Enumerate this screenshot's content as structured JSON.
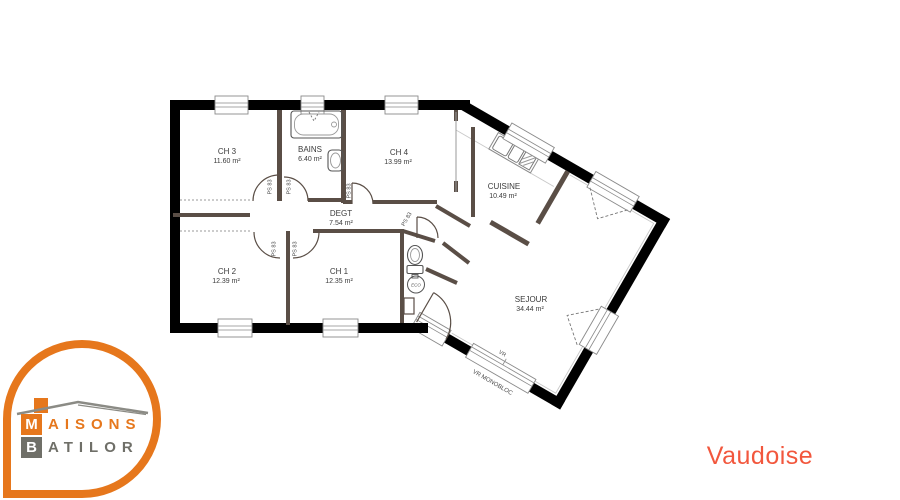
{
  "plan_name": "Vaudoise",
  "logo": {
    "line1_initial": "M",
    "line1_rest": "AISONS",
    "line2_initial": "B",
    "line2_rest": "ATILOR"
  },
  "rooms": {
    "ch3": {
      "name": "CH 3",
      "area": "11.60 m²"
    },
    "bains": {
      "name": "BAINS",
      "area": "6.40 m²"
    },
    "ch4": {
      "name": "CH 4",
      "area": "13.99 m²"
    },
    "cuisine": {
      "name": "CUISINE",
      "area": "10.49 m²"
    },
    "degt": {
      "name": "DEGT",
      "area": "7.54 m²"
    },
    "ch2": {
      "name": "CH 2",
      "area": "12.39 m²"
    },
    "ch1": {
      "name": "CH 1",
      "area": "12.35 m²"
    },
    "sejour": {
      "name": "SEJOUR",
      "area": "34.44 m²"
    }
  },
  "annotations": {
    "door_label": "PS 83",
    "vr": "VR",
    "vr_monobloc": "VR MONOBLOC",
    "eco": "ECO"
  },
  "colors": {
    "accent_orange": "#E6771C",
    "logo_gray": "#6F6F68",
    "outer_wall": "#000000",
    "interior_wall": "#5A4E46",
    "title_coral": "#F2573D"
  }
}
